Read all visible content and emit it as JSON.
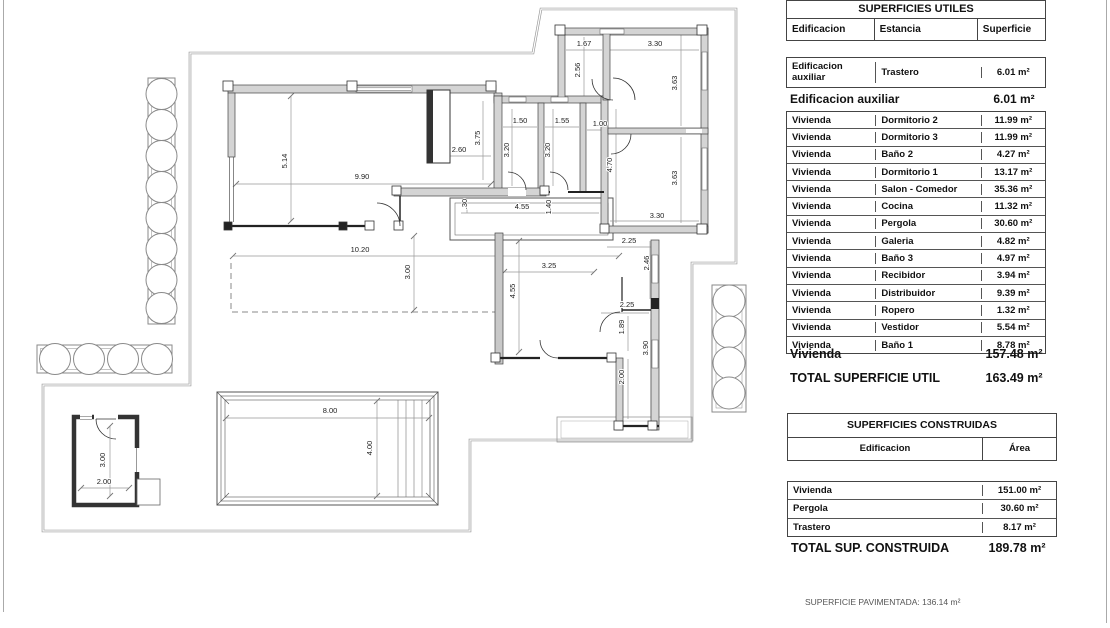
{
  "plan": {
    "dimensions": [
      {
        "t": "5.14",
        "x": 287,
        "y": 161,
        "r": -90
      },
      {
        "t": "9.90",
        "x": 362,
        "y": 179,
        "r": 0
      },
      {
        "t": "2.60",
        "x": 459,
        "y": 152,
        "r": 0
      },
      {
        "t": "3.75",
        "x": 480,
        "y": 138,
        "r": -90
      },
      {
        "t": "10.20",
        "x": 360,
        "y": 252,
        "r": 0
      },
      {
        "t": "3.00",
        "x": 410,
        "y": 272,
        "r": -90
      },
      {
        "t": "1.50",
        "x": 520,
        "y": 123,
        "r": 0
      },
      {
        "t": "1.55",
        "x": 562,
        "y": 123,
        "r": 0
      },
      {
        "t": "1.00",
        "x": 600,
        "y": 126,
        "r": 0
      },
      {
        "t": "3.20",
        "x": 509,
        "y": 150,
        "r": -90
      },
      {
        "t": "3.20",
        "x": 550,
        "y": 150,
        "r": -90
      },
      {
        "t": "1.67",
        "x": 584,
        "y": 46,
        "r": 0
      },
      {
        "t": "3.30",
        "x": 655,
        "y": 46,
        "r": 0
      },
      {
        "t": "2.56",
        "x": 580,
        "y": 70,
        "r": -90
      },
      {
        "t": "3.63",
        "x": 677,
        "y": 83,
        "r": -90
      },
      {
        "t": "3.63",
        "x": 677,
        "y": 178,
        "r": -90
      },
      {
        "t": "3.30",
        "x": 657,
        "y": 218,
        "r": 0
      },
      {
        "t": "4.70",
        "x": 612,
        "y": 165,
        "r": -90
      },
      {
        "t": "2.25",
        "x": 629,
        "y": 243,
        "r": 0
      },
      {
        "t": "2.46",
        "x": 649,
        "y": 263,
        "r": -90
      },
      {
        "t": "4.55",
        "x": 522,
        "y": 209,
        "r": 0
      },
      {
        "t": "1.40",
        "x": 551,
        "y": 207,
        "r": -90
      },
      {
        "t": ".30",
        "x": 467,
        "y": 204,
        "r": -90
      },
      {
        "t": "3.25",
        "x": 549,
        "y": 268,
        "r": 0
      },
      {
        "t": "4.55",
        "x": 515,
        "y": 291,
        "r": -90
      },
      {
        "t": "2.25",
        "x": 627,
        "y": 307,
        "r": 0
      },
      {
        "t": "1.89",
        "x": 624,
        "y": 327,
        "r": -90
      },
      {
        "t": "3.90",
        "x": 648,
        "y": 348,
        "r": -90
      },
      {
        "t": "2.00",
        "x": 624,
        "y": 377,
        "r": -90
      },
      {
        "t": "8.00",
        "x": 330,
        "y": 413,
        "r": 0
      },
      {
        "t": "4.00",
        "x": 372,
        "y": 448,
        "r": -90
      },
      {
        "t": "3.00",
        "x": 105,
        "y": 460,
        "r": -90
      },
      {
        "t": "2.00",
        "x": 104,
        "y": 484,
        "r": 0
      }
    ]
  },
  "tables": {
    "utiles": {
      "title": "SUPERFICIES UTILES",
      "columns": [
        "Edificacion",
        "Estancia",
        "Superficie"
      ],
      "aux_row": {
        "e": "Edificacion auxiliar",
        "s": "Trastero",
        "v": "6.01 m²"
      },
      "aux_subtotal": {
        "label": "Edificacion auxiliar",
        "value": "6.01 m²"
      },
      "rows": [
        {
          "e": "Vivienda",
          "s": "Dormitorio 2",
          "v": "11.99 m²"
        },
        {
          "e": "Vivienda",
          "s": "Dormitorio 3",
          "v": "11.99 m²"
        },
        {
          "e": "Vivienda",
          "s": "Baño 2",
          "v": "4.27 m²"
        },
        {
          "e": "Vivienda",
          "s": "Dormitorio 1",
          "v": "13.17 m²"
        },
        {
          "e": "Vivienda",
          "s": "Salon - Comedor",
          "v": "35.36 m²"
        },
        {
          "e": "Vivienda",
          "s": "Cocina",
          "v": "11.32 m²"
        },
        {
          "e": "Vivienda",
          "s": "Pergola",
          "v": "30.60 m²"
        },
        {
          "e": "Vivienda",
          "s": "Galeria",
          "v": "4.82 m²"
        },
        {
          "e": "Vivienda",
          "s": "Baño 3",
          "v": "4.97 m²"
        },
        {
          "e": "Vivienda",
          "s": "Recibidor",
          "v": "3.94 m²"
        },
        {
          "e": "Vivienda",
          "s": "Distribuidor",
          "v": "9.39 m²"
        },
        {
          "e": "Vivienda",
          "s": "Ropero",
          "v": "1.32 m²"
        },
        {
          "e": "Vivienda",
          "s": "Vestidor",
          "v": "5.54 m²"
        },
        {
          "e": "Vivienda",
          "s": "Baño 1",
          "v": "8.78 m²"
        }
      ],
      "viv_subtotal": {
        "label": "Vivienda",
        "value": "157.48 m²"
      },
      "total": {
        "label": "TOTAL SUPERFICIE UTIL",
        "value": "163.49 m²"
      }
    },
    "construidas": {
      "title": "SUPERFICIES CONSTRUIDAS",
      "columns": [
        "Edificacion",
        "Área"
      ],
      "rows": [
        {
          "e": "Vivienda",
          "v": "151.00 m²"
        },
        {
          "e": "Pergola",
          "v": "30.60 m²"
        },
        {
          "e": "Trastero",
          "v": "8.17 m²"
        }
      ],
      "total": {
        "label": "TOTAL SUP. CONSTRUIDA",
        "value": "189.78 m²"
      }
    }
  },
  "footer": {
    "note": "SUPERFICIE PAVIMENTADA: 136.14 m²"
  }
}
